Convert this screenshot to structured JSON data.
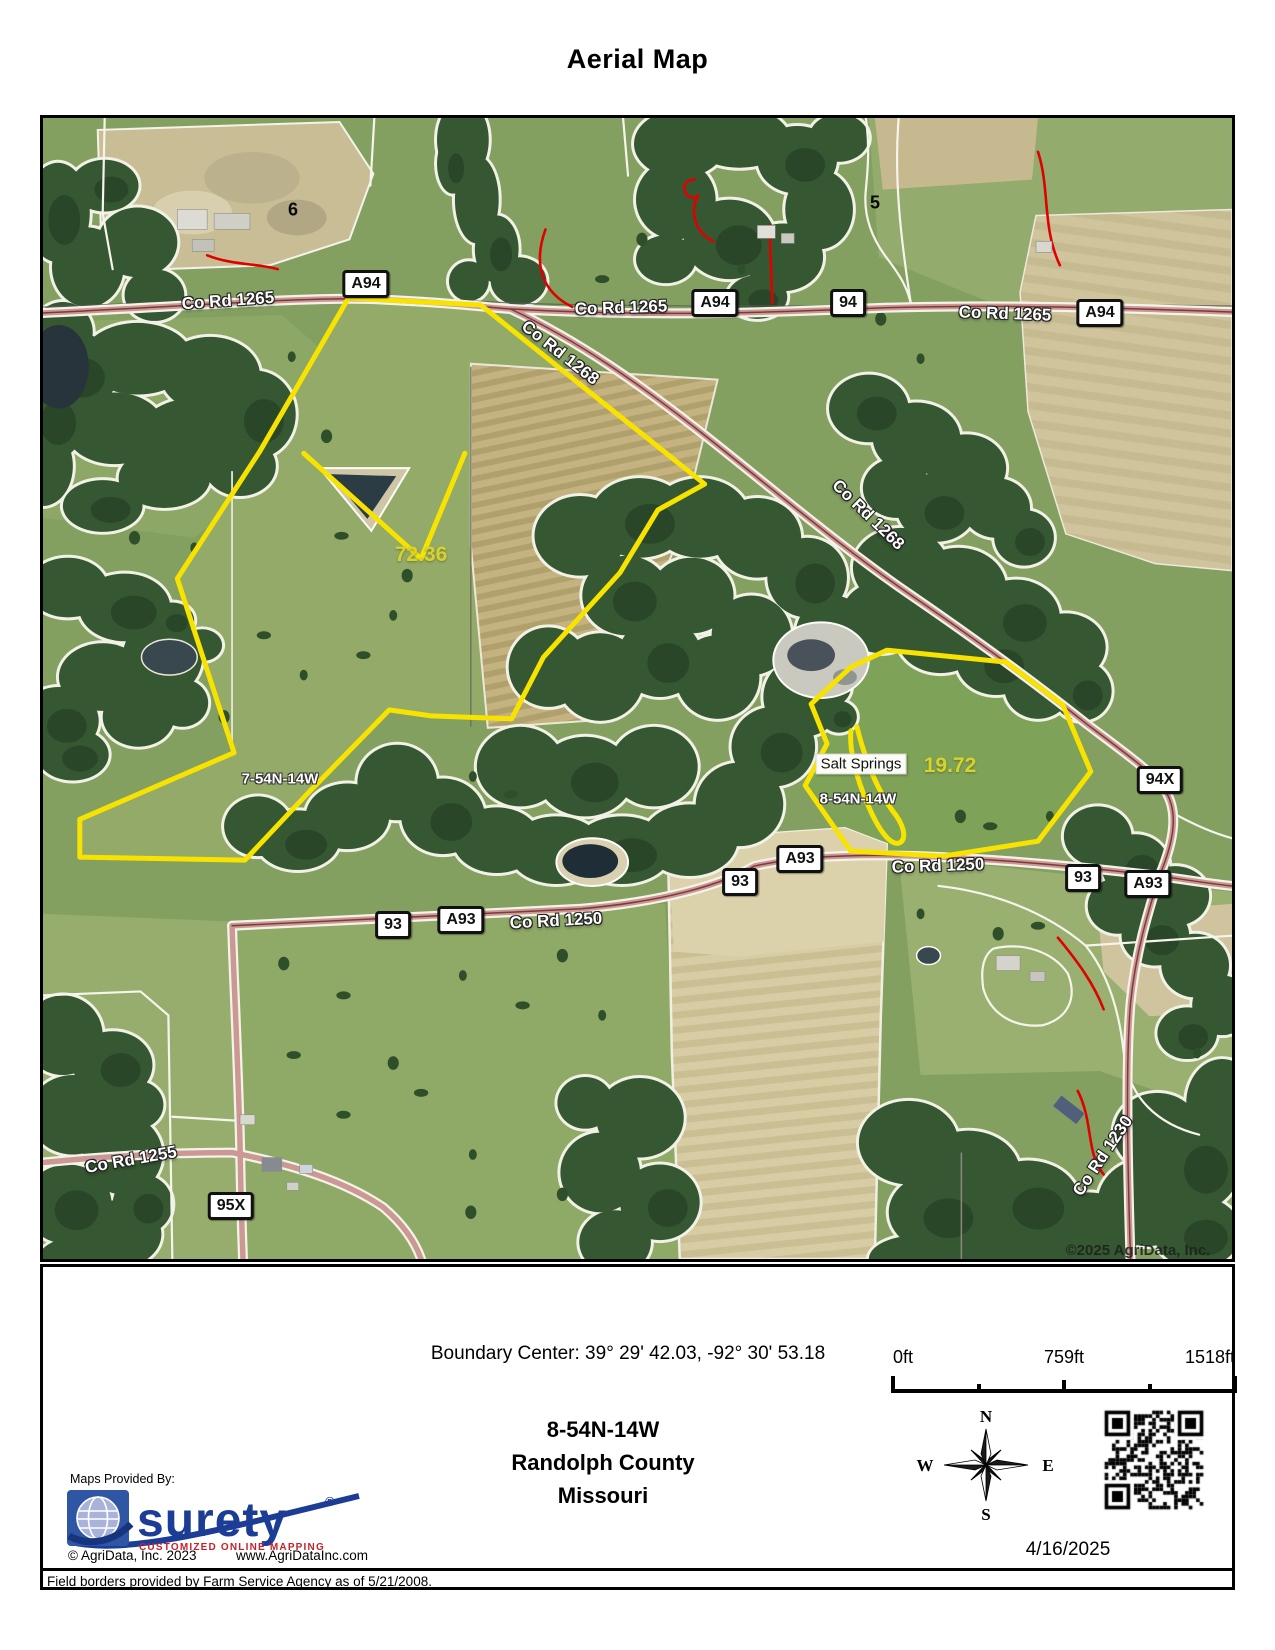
{
  "title": "Aerial Map",
  "map": {
    "watermark": "©2025 AgriData, Inc.",
    "road_badges": [
      {
        "label": "A94",
        "x": 323,
        "y": 166
      },
      {
        "label": "A94",
        "x": 672,
        "y": 185
      },
      {
        "label": "94",
        "x": 805,
        "y": 185
      },
      {
        "label": "A94",
        "x": 1057,
        "y": 195
      },
      {
        "label": "94X",
        "x": 1117,
        "y": 662
      },
      {
        "label": "A93",
        "x": 757,
        "y": 741
      },
      {
        "label": "93",
        "x": 697,
        "y": 764
      },
      {
        "label": "93",
        "x": 1040,
        "y": 760
      },
      {
        "label": "A93",
        "x": 1105,
        "y": 766
      },
      {
        "label": "93",
        "x": 350,
        "y": 807
      },
      {
        "label": "A93",
        "x": 418,
        "y": 802
      },
      {
        "label": "95X",
        "x": 188,
        "y": 1088
      }
    ],
    "road_labels": [
      {
        "text": "Co Rd 1265",
        "x": 185,
        "y": 183,
        "rot": -4
      },
      {
        "text": "Co Rd 1265",
        "x": 578,
        "y": 190,
        "rot": -2
      },
      {
        "text": "Co Rd 1265",
        "x": 962,
        "y": 196,
        "rot": 2
      },
      {
        "text": "Co Rd 1268",
        "x": 517,
        "y": 235,
        "rot": 38
      },
      {
        "text": "Co Rd 1268",
        "x": 825,
        "y": 397,
        "rot": 44
      },
      {
        "text": "Co Rd 1250",
        "x": 895,
        "y": 748,
        "rot": -2
      },
      {
        "text": "Co Rd 1250",
        "x": 513,
        "y": 803,
        "rot": -3
      },
      {
        "text": "Co Rd 1255",
        "x": 88,
        "y": 1042,
        "rot": -10
      },
      {
        "text": "Co Rd 1230",
        "x": 1060,
        "y": 1038,
        "rot": -56
      }
    ],
    "parcel_labels": [
      {
        "text": "72.36",
        "x": 378,
        "y": 437
      },
      {
        "text": "19.72",
        "x": 907,
        "y": 648
      }
    ],
    "area_labels": [
      {
        "text": "7-54N-14W",
        "x": 237,
        "y": 661
      },
      {
        "text": "8-54N-14W",
        "x": 815,
        "y": 681
      }
    ],
    "poi_labels": [
      {
        "text": "Salt Springs",
        "x": 818,
        "y": 646
      }
    ],
    "field_numbers": [
      {
        "text": "6",
        "x": 250,
        "y": 92
      },
      {
        "text": "5",
        "x": 832,
        "y": 85
      }
    ]
  },
  "footer": {
    "boundary_center": "Boundary Center: 39° 29' 42.03,  -92° 30' 53.18",
    "scale": {
      "start": "0ft",
      "mid": "759ft",
      "end": "1518ft"
    },
    "location": {
      "trs": "8-54N-14W",
      "county": "Randolph County",
      "state": "Missouri"
    },
    "compass": {
      "north": "N",
      "east": "E",
      "south": "S",
      "west": "W"
    },
    "date": "4/16/2025",
    "provider": {
      "label": "Maps Provided By:",
      "brand": "surety",
      "reg": "®",
      "tagline": "CUSTOMIZED ONLINE MAPPING",
      "copyright": "© AgriData, Inc. 2023",
      "website": "www.AgriDataInc.com"
    },
    "disclaimer": "Field borders provided by Farm Service Agency as of 5/21/2008."
  }
}
